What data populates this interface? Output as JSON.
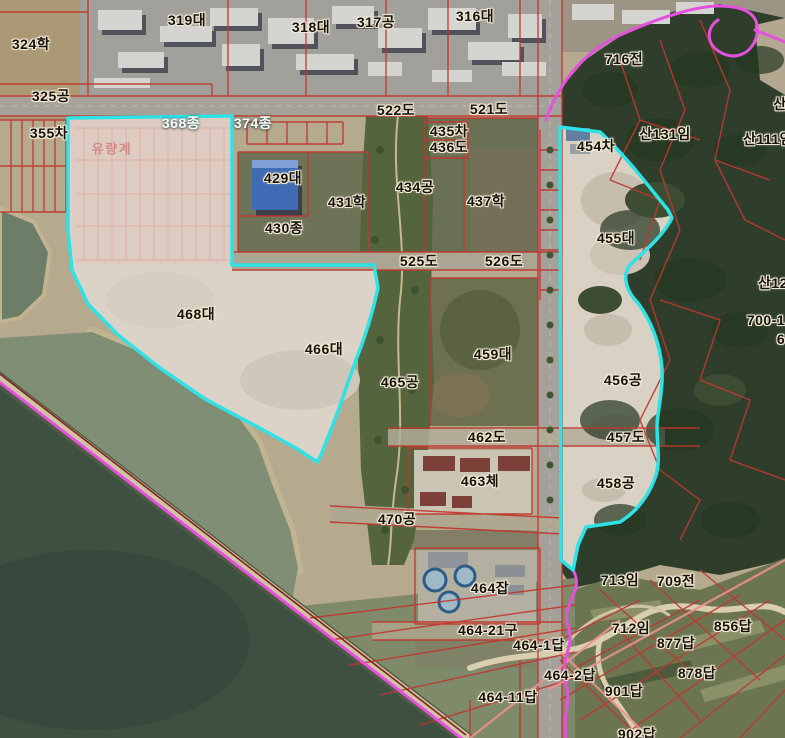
{
  "map": {
    "description": "Cadastral parcel boundary overlay on aerial photograph",
    "colors": {
      "highlight_boundary_cyan": "#2ee2e6",
      "district_boundary_magenta": "#e551de",
      "cadastral_line_red": "#c0372e",
      "faint_lot_grid_pink": "#dc9a93",
      "label_halo": "#f1ead6",
      "water_dark": "#3e5042",
      "water_light": "#7f8e74",
      "forest": "#2f3e2b",
      "cleared_land": "#dbd3c8"
    },
    "labels": [
      {
        "text": "324학",
        "x": 31,
        "y": 44,
        "variant": "dark"
      },
      {
        "text": "319대",
        "x": 187,
        "y": 20,
        "variant": "dark"
      },
      {
        "text": "318대",
        "x": 311,
        "y": 27,
        "variant": "dark"
      },
      {
        "text": "317공",
        "x": 376,
        "y": 22,
        "variant": "dark"
      },
      {
        "text": "316대",
        "x": 475,
        "y": 16,
        "variant": "dark"
      },
      {
        "text": "325공",
        "x": 51,
        "y": 96,
        "variant": "dark"
      },
      {
        "text": "355차",
        "x": 49,
        "y": 133,
        "variant": "dark"
      },
      {
        "text": "368종",
        "x": 181,
        "y": 123,
        "variant": "light"
      },
      {
        "text": "374종",
        "x": 253,
        "y": 123,
        "variant": "light"
      },
      {
        "text": "유량계",
        "x": 112,
        "y": 149,
        "variant": "faint"
      },
      {
        "text": "522도",
        "x": 396,
        "y": 110,
        "variant": "dark"
      },
      {
        "text": "521도",
        "x": 489,
        "y": 109,
        "variant": "dark"
      },
      {
        "text": "435차",
        "x": 449,
        "y": 131,
        "variant": "dark"
      },
      {
        "text": "436도",
        "x": 449,
        "y": 147,
        "variant": "dark"
      },
      {
        "text": "716전",
        "x": 624,
        "y": 59,
        "variant": "dark"
      },
      {
        "text": "산",
        "x": 780,
        "y": 104,
        "variant": "dark"
      },
      {
        "text": "산131임",
        "x": 665,
        "y": 134,
        "variant": "dark"
      },
      {
        "text": "산111임",
        "x": 768,
        "y": 139,
        "variant": "dark"
      },
      {
        "text": "454차",
        "x": 596,
        "y": 146,
        "variant": "dark"
      },
      {
        "text": "429대",
        "x": 283,
        "y": 178,
        "variant": "dark"
      },
      {
        "text": "434공",
        "x": 415,
        "y": 187,
        "variant": "dark"
      },
      {
        "text": "437학",
        "x": 486,
        "y": 201,
        "variant": "dark"
      },
      {
        "text": "431학",
        "x": 347,
        "y": 202,
        "variant": "dark"
      },
      {
        "text": "430종",
        "x": 284,
        "y": 228,
        "variant": "dark"
      },
      {
        "text": "455대",
        "x": 616,
        "y": 238,
        "variant": "dark"
      },
      {
        "text": "525도",
        "x": 419,
        "y": 261,
        "variant": "dark"
      },
      {
        "text": "526도",
        "x": 504,
        "y": 261,
        "variant": "dark"
      },
      {
        "text": "산12",
        "x": 773,
        "y": 283,
        "variant": "dark"
      },
      {
        "text": "468대",
        "x": 196,
        "y": 314,
        "variant": "dark"
      },
      {
        "text": "700-1",
        "x": 766,
        "y": 320,
        "variant": "dark"
      },
      {
        "text": "6",
        "x": 781,
        "y": 339,
        "variant": "dark"
      },
      {
        "text": "466대",
        "x": 324,
        "y": 349,
        "variant": "dark"
      },
      {
        "text": "459대",
        "x": 493,
        "y": 354,
        "variant": "dark"
      },
      {
        "text": "456공",
        "x": 623,
        "y": 380,
        "variant": "dark"
      },
      {
        "text": "465공",
        "x": 400,
        "y": 382,
        "variant": "dark"
      },
      {
        "text": "462도",
        "x": 487,
        "y": 437,
        "variant": "dark"
      },
      {
        "text": "457도",
        "x": 626,
        "y": 437,
        "variant": "dark"
      },
      {
        "text": "463체",
        "x": 480,
        "y": 481,
        "variant": "dark"
      },
      {
        "text": "458공",
        "x": 616,
        "y": 483,
        "variant": "dark"
      },
      {
        "text": "470공",
        "x": 397,
        "y": 519,
        "variant": "dark"
      },
      {
        "text": "713임",
        "x": 620,
        "y": 580,
        "variant": "dark"
      },
      {
        "text": "709전",
        "x": 676,
        "y": 581,
        "variant": "dark"
      },
      {
        "text": "464잡",
        "x": 490,
        "y": 588,
        "variant": "dark"
      },
      {
        "text": "856답",
        "x": 733,
        "y": 626,
        "variant": "dark"
      },
      {
        "text": "712임",
        "x": 631,
        "y": 628,
        "variant": "dark"
      },
      {
        "text": "464-21구",
        "x": 488,
        "y": 630,
        "variant": "dark"
      },
      {
        "text": "877답",
        "x": 676,
        "y": 643,
        "variant": "dark"
      },
      {
        "text": "464-1답",
        "x": 539,
        "y": 645,
        "variant": "dark"
      },
      {
        "text": "878답",
        "x": 697,
        "y": 673,
        "variant": "dark"
      },
      {
        "text": "464-2답",
        "x": 570,
        "y": 675,
        "variant": "dark"
      },
      {
        "text": "901답",
        "x": 624,
        "y": 691,
        "variant": "dark"
      },
      {
        "text": "464-11답",
        "x": 508,
        "y": 697,
        "variant": "dark"
      },
      {
        "text": "902답",
        "x": 637,
        "y": 734,
        "variant": "dark"
      }
    ]
  }
}
